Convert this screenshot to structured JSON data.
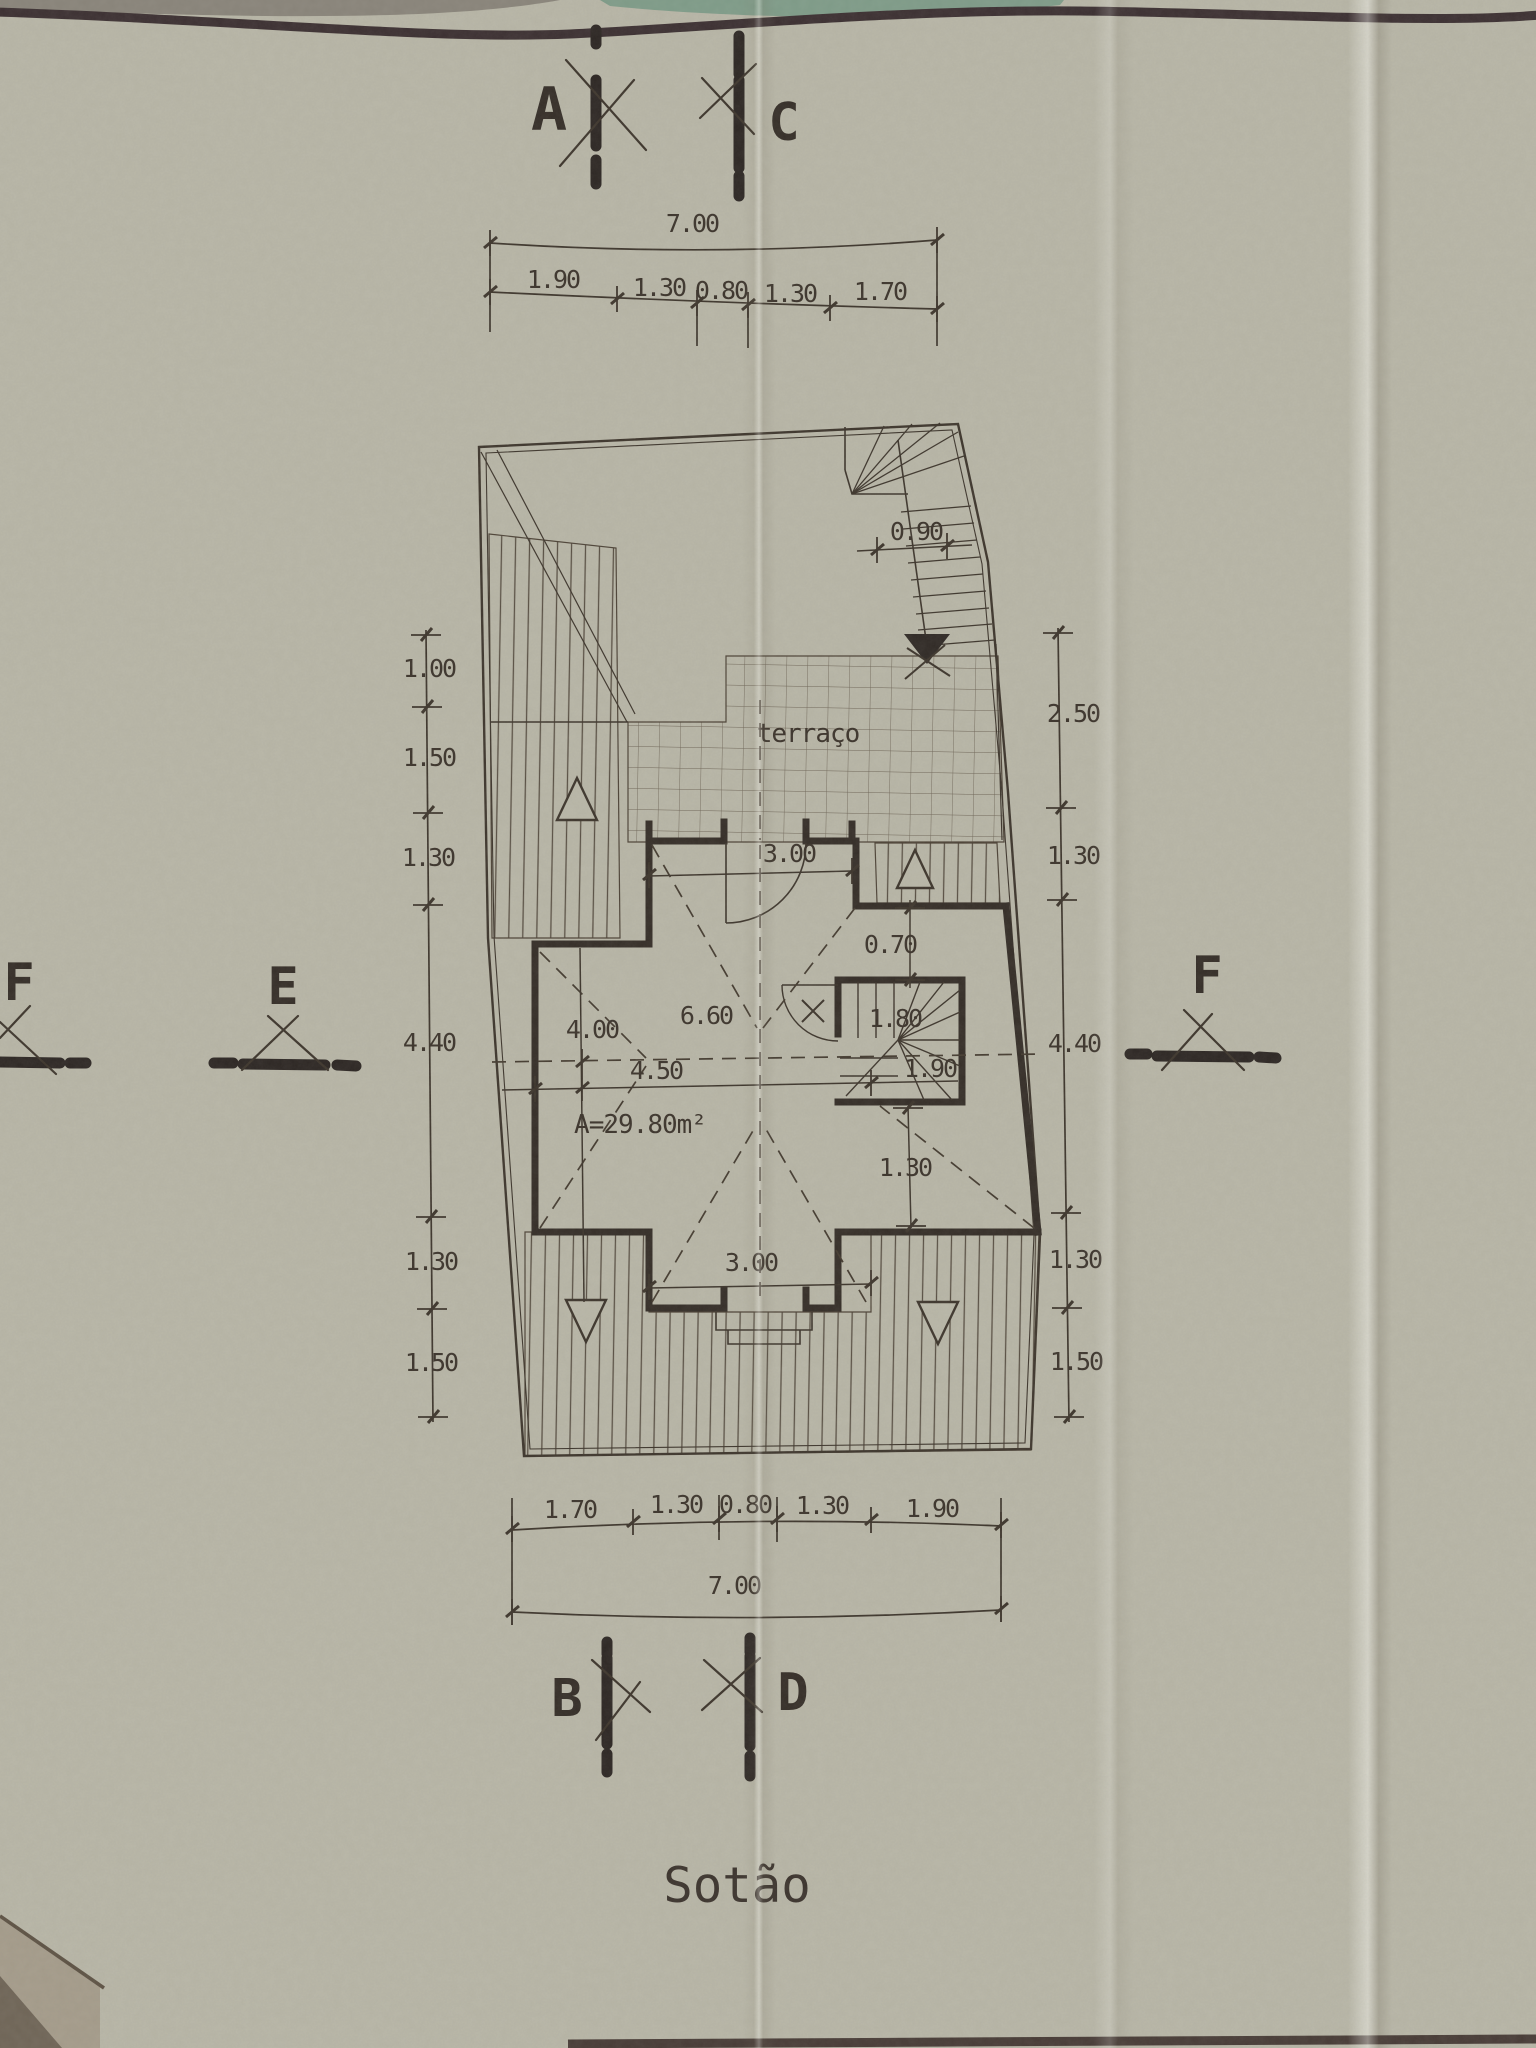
{
  "title": "Sotão",
  "markers": {
    "top_left": "A",
    "top_right": "C",
    "bottom_left": "B",
    "bottom_right": "D",
    "left": "E",
    "right": "F",
    "edge_left": "F"
  },
  "dim_top": {
    "total": "7.00",
    "segments": [
      "1.90",
      "1.30",
      "0.80",
      "1.30",
      "1.70"
    ]
  },
  "dim_bottom": {
    "segments": [
      "1.70",
      "1.30",
      "0.80",
      "1.30",
      "1.90"
    ],
    "total": "7.00"
  },
  "dim_left": [
    "1.00",
    "1.50",
    "1.30",
    "4.40",
    "1.30",
    "1.50"
  ],
  "dim_right": [
    "2.50",
    "1.30",
    "4.40",
    "1.30",
    "1.50"
  ],
  "plan": {
    "terrace_label": "terraço",
    "area_label": "A=29.80m²",
    "stair_width": "0.90",
    "top_door": "3.00",
    "passage": "0.70",
    "ridge_span": "6.60",
    "left_span": "4.00",
    "center_span": "4.50",
    "stair_w": "1.80",
    "stair_d": "1.90",
    "below_stair": "1.30",
    "bottom_door": "3.00"
  },
  "colors": {
    "paper": "#b8b6a7",
    "ink": "#3c342b",
    "bold_ink": "#2b2522",
    "green_edge": "#7e9b88"
  }
}
